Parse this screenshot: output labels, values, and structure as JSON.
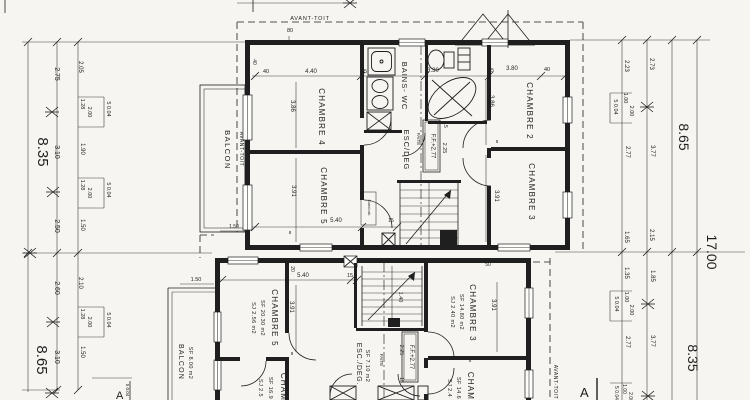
{
  "style": {
    "paper": "#f6f5f1",
    "ink": "#1f1f1f"
  },
  "upper_plan": {
    "avant_toit_top": "AVANT-TOIT",
    "avant_toit_side": "AVANT-TOIT",
    "balcon": "BALCON",
    "chambre4": "CHAMBRE 4",
    "chambre5": "CHAMBRE 5",
    "chambre2": "CHAMBRE 2",
    "chambre3": "CHAMBRE 3",
    "bains_wc": "BAINS- WC",
    "esc_deg": "ESC/DEG",
    "faite": "FAITE",
    "level": "F.F.+2.77",
    "garde_robe": "Gard.rob."
  },
  "lower_plan": {
    "balcon": "BALCON",
    "balcon_area": "SF 8.00 m2",
    "avant_toit_side": "AVANT-TOIT",
    "chambre5": "CHAMBRE 5",
    "chambre5_sf": "SF 20.30 m2",
    "chambre5_sj": "SJ 2.56 m2",
    "chambre3": "CHAMBRE 3",
    "chambre3_sf": "SF 14.80 m2",
    "chambre3_sj": "SJ 2.40 m2",
    "esc_deg": "ESC./DEG.",
    "esc_deg_sf": "SF 7.10 m2",
    "faite": "FAITE",
    "level": "F.F.+2.77",
    "room_bl": "CHAM",
    "room_bl_sf": "SF 16.9",
    "room_bl_sj": "SJ 2.5",
    "room_br": "CHAM",
    "room_br_sf": "SF 14.6",
    "room_br_sj": "SJ 2.4"
  },
  "section": {
    "left": "A",
    "right": "A"
  },
  "dim_labels": [
    {
      "t": "8.35",
      "x": 38,
      "y": 152,
      "r": 1,
      "s": 15
    },
    {
      "t": "8.65",
      "x": 37,
      "y": 360,
      "r": 1,
      "s": 15
    },
    {
      "t": "2.75",
      "x": 55,
      "y": 74,
      "r": 1,
      "s": 7
    },
    {
      "t": "3.10",
      "x": 55,
      "y": 152,
      "r": 1,
      "s": 7
    },
    {
      "t": "2.50",
      "x": 55,
      "y": 226,
      "r": 1,
      "s": 7
    },
    {
      "t": "2.05",
      "x": 79,
      "y": 67,
      "r": 1,
      "s": 6
    },
    {
      "t": "1.28",
      "x": 81,
      "y": 104,
      "r": 1,
      "s": 5.5
    },
    {
      "t": "2.00",
      "x": 88,
      "y": 112,
      "r": 1,
      "s": 5.5
    },
    {
      "t": "5 0.04",
      "x": 107,
      "y": 109,
      "r": 1,
      "s": 5.5
    },
    {
      "t": "1.90",
      "x": 81,
      "y": 149,
      "r": 1,
      "s": 6
    },
    {
      "t": "1.28",
      "x": 81,
      "y": 185,
      "r": 1,
      "s": 5.5
    },
    {
      "t": "2.00",
      "x": 88,
      "y": 193,
      "r": 1,
      "s": 5.5
    },
    {
      "t": "5 0.04",
      "x": 107,
      "y": 190,
      "r": 1,
      "s": 5.5
    },
    {
      "t": "1.50",
      "x": 81,
      "y": 225,
      "r": 1,
      "s": 6
    },
    {
      "t": "2.60",
      "x": 55,
      "y": 288,
      "r": 1,
      "s": 7
    },
    {
      "t": "3.10",
      "x": 55,
      "y": 357,
      "r": 1,
      "s": 7
    },
    {
      "t": "2.10",
      "x": 79,
      "y": 283,
      "r": 1,
      "s": 6
    },
    {
      "t": "1.28",
      "x": 81,
      "y": 314,
      "r": 1,
      "s": 5.5
    },
    {
      "t": "2.00",
      "x": 88,
      "y": 322,
      "r": 1,
      "s": 5.5
    },
    {
      "t": "5 0.04",
      "x": 107,
      "y": 320,
      "r": 1,
      "s": 5.5
    },
    {
      "t": "1.50",
      "x": 81,
      "y": 352,
      "r": 1,
      "s": 6
    },
    {
      "t": "5 0.04",
      "x": 126,
      "y": 390,
      "r": 1,
      "s": 4.5
    },
    {
      "t": "2.23",
      "x": 625,
      "y": 66,
      "r": 1,
      "s": 6
    },
    {
      "t": "2.73",
      "x": 650,
      "y": 64,
      "r": 1,
      "s": 6
    },
    {
      "t": "1.00",
      "x": 624,
      "y": 98,
      "r": 1,
      "s": 5.5
    },
    {
      "t": "2.00",
      "x": 630,
      "y": 111,
      "r": 1,
      "s": 5.5
    },
    {
      "t": "5 0.04",
      "x": 614,
      "y": 107,
      "r": 1,
      "s": 5.5
    },
    {
      "t": "2.77",
      "x": 626,
      "y": 152,
      "r": 1,
      "s": 6
    },
    {
      "t": "3.77",
      "x": 651,
      "y": 151,
      "r": 1,
      "s": 6
    },
    {
      "t": "1.65",
      "x": 625,
      "y": 237,
      "r": 1,
      "s": 6
    },
    {
      "t": "2.15",
      "x": 650,
      "y": 235,
      "r": 1,
      "s": 6
    },
    {
      "t": "8.65",
      "x": 679,
      "y": 137,
      "r": 1,
      "s": 14
    },
    {
      "t": "1.35",
      "x": 625,
      "y": 273,
      "r": 1,
      "s": 6
    },
    {
      "t": "1.85",
      "x": 651,
      "y": 276,
      "r": 1,
      "s": 6
    },
    {
      "t": "1.00",
      "x": 625,
      "y": 297,
      "r": 1,
      "s": 5.5
    },
    {
      "t": "2.00",
      "x": 630,
      "y": 310,
      "r": 1,
      "s": 5.5
    },
    {
      "t": "5 0.04",
      "x": 615,
      "y": 304,
      "r": 1,
      "s": 5.5
    },
    {
      "t": "2.77",
      "x": 626,
      "y": 342,
      "r": 1,
      "s": 6
    },
    {
      "t": "3.77",
      "x": 651,
      "y": 341,
      "r": 1,
      "s": 6
    },
    {
      "t": "8.35",
      "x": 688,
      "y": 358,
      "r": 1,
      "s": 14
    },
    {
      "t": "17.00",
      "x": 707,
      "y": 252,
      "r": 1,
      "s": 14
    },
    {
      "t": "1.00",
      "x": 623,
      "y": 389,
      "r": 1,
      "s": 5
    },
    {
      "t": "2.00",
      "x": 629,
      "y": 397,
      "r": 1,
      "s": 5
    },
    {
      "t": "5 0.04",
      "x": 615,
      "y": 393,
      "r": 1,
      "s": 5
    },
    {
      "t": "40",
      "x": 266,
      "y": 73,
      "r": 0,
      "s": 5.5
    },
    {
      "t": "4.40",
      "x": 311,
      "y": 73,
      "r": 0,
      "s": 6
    },
    {
      "t": "15",
      "x": 364,
      "y": 73,
      "r": 0,
      "s": 5.5
    },
    {
      "t": "3.30",
      "x": 433,
      "y": 72,
      "r": 0,
      "s": 6
    },
    {
      "t": "15",
      "x": 491,
      "y": 72,
      "r": 0,
      "s": 5.5
    },
    {
      "t": "3.80",
      "x": 512,
      "y": 70,
      "r": 0,
      "s": 6
    },
    {
      "t": "40",
      "x": 547,
      "y": 71,
      "r": 0,
      "s": 5.5
    },
    {
      "t": "80",
      "x": 290,
      "y": 32,
      "r": 0,
      "s": 5.5
    },
    {
      "t": "40",
      "x": 253,
      "y": 62,
      "r": 1,
      "s": 5
    },
    {
      "t": "3.86",
      "x": 291,
      "y": 106,
      "r": 1,
      "s": 6
    },
    {
      "t": "3.91",
      "x": 292,
      "y": 191,
      "r": 1,
      "s": 6
    },
    {
      "t": "3.86",
      "x": 490,
      "y": 101,
      "r": 1,
      "s": 6
    },
    {
      "t": "3.91",
      "x": 495,
      "y": 196,
      "r": 1,
      "s": 6
    },
    {
      "t": "15",
      "x": 444,
      "y": 125,
      "r": 1,
      "s": 5
    },
    {
      "t": "2.25",
      "x": 443,
      "y": 148,
      "r": 1,
      "s": 5.5
    },
    {
      "t": "5.40",
      "x": 336,
      "y": 222,
      "r": 0,
      "s": 6
    },
    {
      "t": "15",
      "x": 391,
      "y": 222,
      "r": 0,
      "s": 5
    },
    {
      "t": "8",
      "x": 290,
      "y": 234,
      "r": 0,
      "s": 4.5
    },
    {
      "t": "8",
      "x": 497,
      "y": 143,
      "r": 0,
      "s": 4.5
    },
    {
      "t": "1.50",
      "x": 234,
      "y": 228,
      "r": 0,
      "s": 5
    },
    {
      "t": "5.40",
      "x": 303,
      "y": 277,
      "r": 0,
      "s": 6
    },
    {
      "t": "15",
      "x": 350,
      "y": 277,
      "r": 0,
      "s": 5.5
    },
    {
      "t": "20",
      "x": 291,
      "y": 269,
      "r": 1,
      "s": 5
    },
    {
      "t": "3.91",
      "x": 290,
      "y": 307,
      "r": 1,
      "s": 6
    },
    {
      "t": "3.91",
      "x": 492,
      "y": 305,
      "r": 1,
      "s": 6
    },
    {
      "t": "1.40",
      "x": 399,
      "y": 297,
      "r": 1,
      "s": 5.5
    },
    {
      "t": "50",
      "x": 488,
      "y": 266,
      "r": 0,
      "s": 5
    },
    {
      "t": "2.25",
      "x": 400,
      "y": 350,
      "r": 1,
      "s": 5.5
    },
    {
      "t": "15",
      "x": 400,
      "y": 380,
      "r": 1,
      "s": 5
    },
    {
      "t": "1.50",
      "x": 196,
      "y": 281,
      "r": 0,
      "s": 5.5
    },
    {
      "t": "8",
      "x": 292,
      "y": 355,
      "r": 0,
      "s": 4.5
    },
    {
      "t": "8",
      "x": 470,
      "y": 362,
      "r": 0,
      "s": 4.5
    }
  ]
}
